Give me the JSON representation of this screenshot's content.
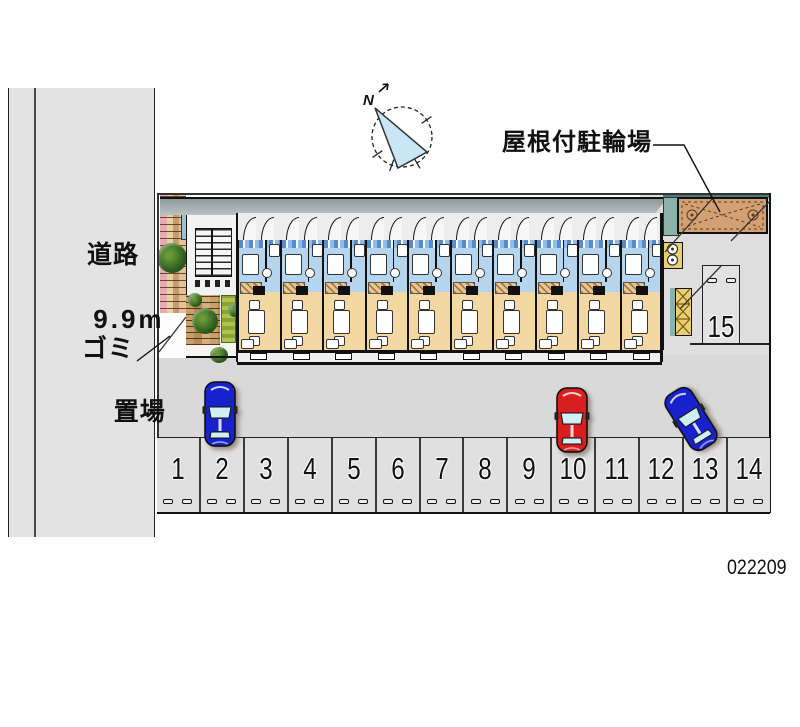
{
  "plan_number": "022209",
  "labels": {
    "road_line1": "道路",
    "road_line2": "9.9m",
    "garbage_line1": "ゴミ",
    "garbage_line2": "置場",
    "covered_bicycle_parking": "屋根付駐輪場",
    "north": "N"
  },
  "parking": {
    "row_spaces": [
      "1",
      "2",
      "3",
      "4",
      "5",
      "6",
      "7",
      "8",
      "9",
      "10",
      "11",
      "12",
      "13",
      "14"
    ],
    "side_space": "15"
  },
  "cars": [
    {
      "space": "2",
      "body": "blue",
      "color": "#1822cc",
      "angle_deg": 0
    },
    {
      "space": "10",
      "body": "red",
      "color": "#d81e1e",
      "angle_deg": 0
    },
    {
      "space": "13",
      "body": "blue",
      "color": "#1822cc",
      "angle_deg": -32
    }
  ],
  "building": {
    "unit_count": 10
  },
  "colors": {
    "road_gray": "#e3e3e3",
    "ground_gray": "#d9d9d9",
    "parking_gray": "#e0e0e0",
    "unit_blue": "#b5d4ee",
    "unit_tan": "#f4d8a4",
    "shed_brown": "#d2a072",
    "teal": "#8cb0ac",
    "compass_blue": "#c8e6f6",
    "window_cyan": "#cfeef5"
  }
}
